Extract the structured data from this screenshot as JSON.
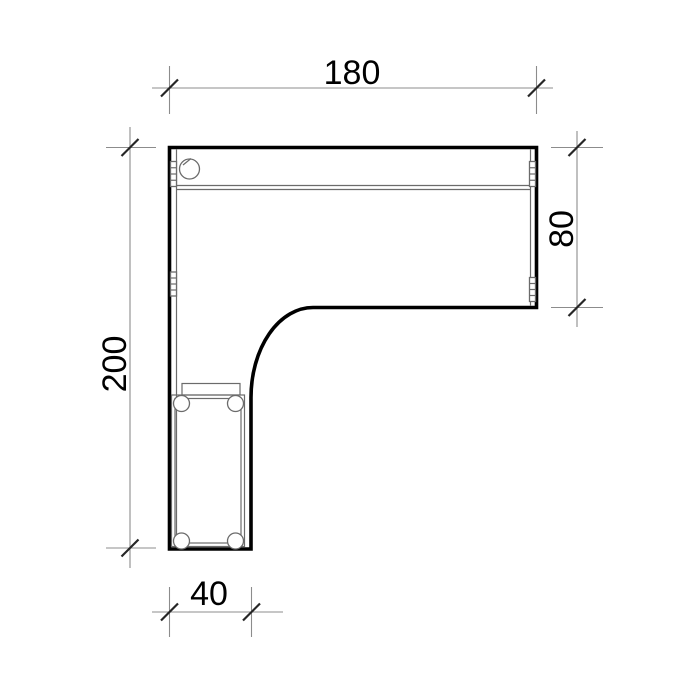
{
  "page": {
    "title": "L-shaped desk — dimensioned plan view",
    "background": "#ffffff"
  },
  "colors": {
    "outline": "#000000",
    "detail_line": "#6b6b6b",
    "dimension_line": "#8c8c8c",
    "tick": "#262626",
    "label_text": "#000000"
  },
  "drawing": {
    "type": "technical-plan-drawing",
    "object": "l-shaped-corner-desk-top",
    "dimensions": {
      "top_width": {
        "label": "180",
        "value": 180,
        "edge": "top",
        "orientation": "horizontal"
      },
      "right_depth": {
        "label": "80",
        "value": 80,
        "edge": "right",
        "orientation": "vertical"
      },
      "left_depth": {
        "label": "200",
        "value": 200,
        "edge": "left",
        "orientation": "vertical"
      },
      "bottom_width": {
        "label": "40",
        "value": 40,
        "edge": "bottom",
        "orientation": "horizontal"
      }
    },
    "features": [
      "cable-grommet-hole",
      "edge-band-lines",
      "hinge-markers",
      "pedestal-with-casters",
      "inner-corner-fillet"
    ]
  }
}
